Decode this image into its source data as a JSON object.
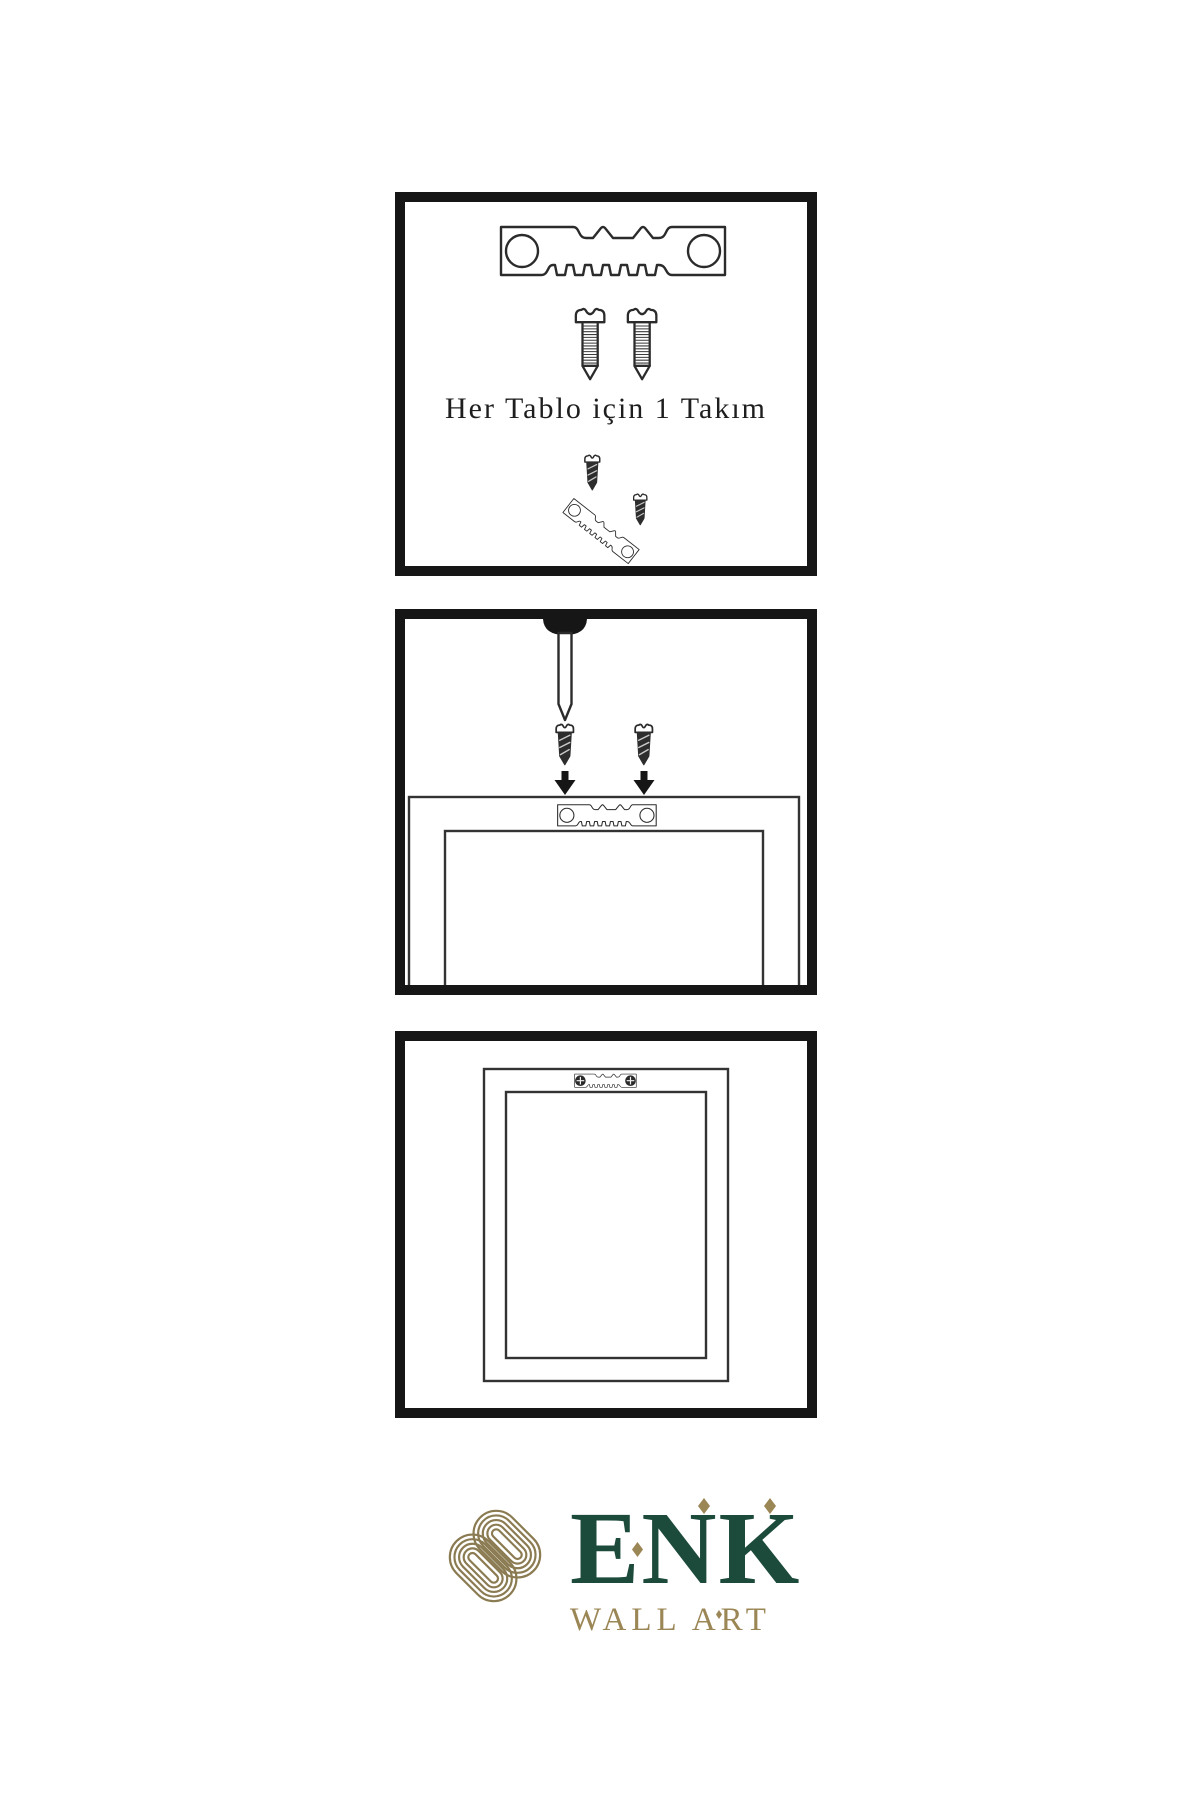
{
  "canvas": {
    "background": "#ffffff",
    "panel_border_color": "#161616",
    "line_color": "#2b2b2b"
  },
  "step1": {
    "caption": "Her Tablo için 1 Takım",
    "items": [
      "sawtooth-hanger",
      "screw",
      "screw",
      "assembled-hanger-with-screws"
    ]
  },
  "step2": {
    "items": [
      "wall-nail",
      "screw",
      "screw",
      "down-arrow",
      "down-arrow",
      "frame-back-with-hanger"
    ]
  },
  "step3": {
    "items": [
      "hung-frame-back-with-mounted-hanger"
    ]
  },
  "logo": {
    "name": "ENK",
    "subtitle": "WALL ART",
    "green": "#1d4b3b",
    "gold": "#9b8655",
    "knot_gold": "#8b7b52"
  }
}
